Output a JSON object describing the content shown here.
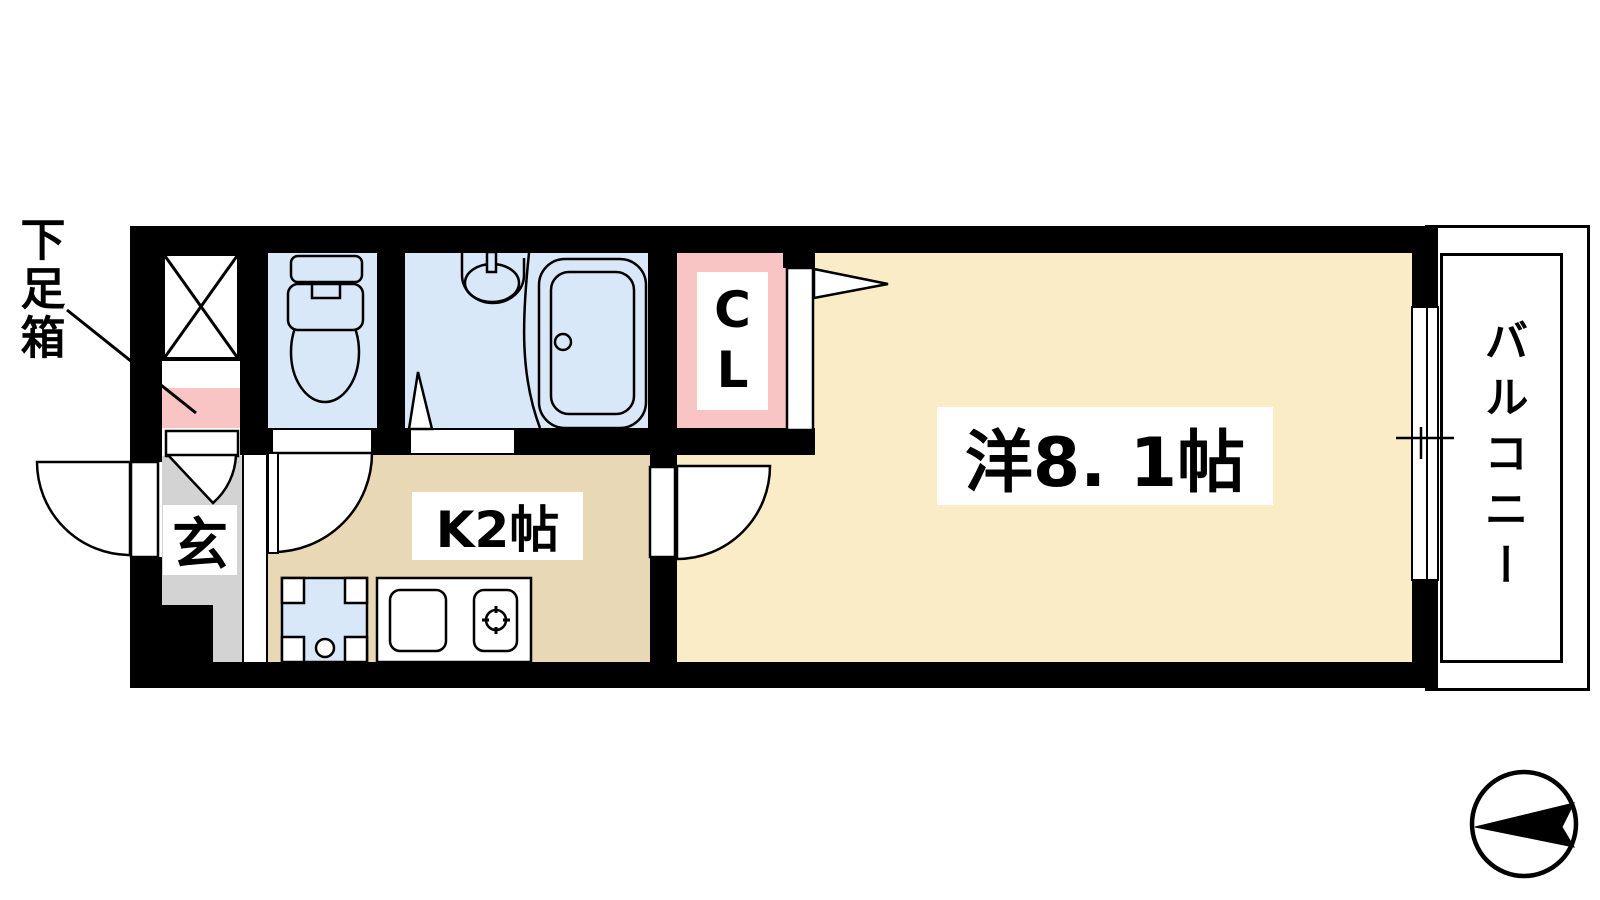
{
  "plan": {
    "type": "apartment-floor-plan",
    "labels": {
      "shoe_box": "下足箱",
      "entrance": "玄",
      "kitchen": "K2帖",
      "main_room": "洋8. 1帖",
      "closet": "CL",
      "balcony": "バルコニー"
    },
    "rooms": [
      {
        "name": "western-room",
        "size_text": "洋8. 1帖"
      },
      {
        "name": "kitchen",
        "size_text": "K2帖"
      },
      {
        "name": "closet",
        "size_text": "CL"
      },
      {
        "name": "entrance",
        "size_text": "玄"
      },
      {
        "name": "balcony",
        "size_text": "バルコニー"
      },
      {
        "name": "shoe-cabinet",
        "size_text": "下足箱"
      }
    ],
    "colors": {
      "wall": "#000000",
      "main_room_floor": "#f9ecc6",
      "kitchen_floor": "#e9d8b5",
      "wet_area_blue": "#d9e8f8",
      "closet_pink": "#f9c4c4",
      "entrance_gray": "#d3d3d3",
      "line": "#000000",
      "label_background": "#ffffff"
    },
    "compass": {
      "style": "black arrow in circle",
      "points": "left"
    }
  }
}
